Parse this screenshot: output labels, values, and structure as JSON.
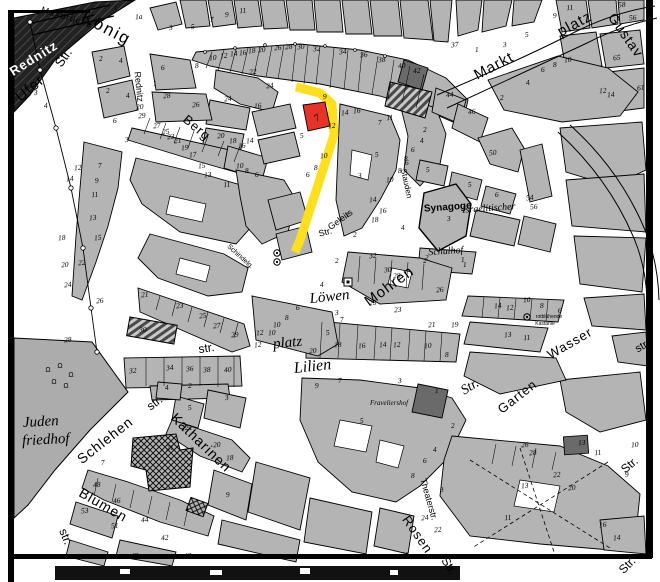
{
  "map": {
    "kind": "historical city cadastral map",
    "highlight": {
      "street_color": "#FFDF1E",
      "parcel_color": "#E63329",
      "parcel_number": "7"
    },
    "street_labels": [
      {
        "t": "Maxbrücke",
        "x": 66,
        "y": 20,
        "r": 17,
        "s": 9,
        "f": "s",
        "sp": 1
      },
      {
        "t": "König",
        "x": 104,
        "y": 33,
        "r": 28,
        "s": 17,
        "f": "s",
        "sp": 2
      },
      {
        "t": "Str.",
        "x": 67,
        "y": 60,
        "r": -55,
        "s": 13,
        "f": "s"
      },
      {
        "t": "Ufer",
        "x": 33,
        "y": 92,
        "r": -40,
        "s": 15,
        "f": "s",
        "sp": 1
      },
      {
        "t": "Rednitz",
        "x": 136,
        "y": 87,
        "r": 84,
        "s": 9,
        "f": "s"
      },
      {
        "t": "Berg",
        "x": 194,
        "y": 131,
        "r": 40,
        "s": 13,
        "f": "s",
        "sp": 1
      },
      {
        "t": "Markt",
        "x": 496,
        "y": 70,
        "r": -28,
        "s": 15,
        "f": "s",
        "sp": 1
      },
      {
        "t": "platz",
        "x": 577,
        "y": 28,
        "r": -28,
        "s": 15,
        "f": "s",
        "sp": 1
      },
      {
        "t": "Gustav",
        "x": 622,
        "y": 38,
        "r": 55,
        "s": 14,
        "f": "s",
        "sp": 1
      },
      {
        "t": "Stauden",
        "x": 404,
        "y": 184,
        "r": 78,
        "s": 8,
        "f": "s"
      },
      {
        "t": "Geleits",
        "x": 342,
        "y": 222,
        "r": -36,
        "s": 9,
        "f": "s"
      },
      {
        "t": "Str.",
        "x": 326,
        "y": 235,
        "r": -15,
        "s": 9,
        "f": "s"
      },
      {
        "t": "Schindelg.",
        "x": 239,
        "y": 258,
        "r": 42,
        "s": 7,
        "f": "s"
      },
      {
        "t": "Mohren",
        "x": 392,
        "y": 290,
        "r": -36,
        "s": 15,
        "f": "s",
        "sp": 1
      },
      {
        "t": "Löwen",
        "x": 330,
        "y": 301,
        "r": -6,
        "s": 15,
        "f": "i"
      },
      {
        "t": "platz",
        "x": 288,
        "y": 347,
        "r": -6,
        "s": 15,
        "f": "i"
      },
      {
        "t": "str.",
        "x": 207,
        "y": 352,
        "r": -8,
        "s": 12,
        "f": "s"
      },
      {
        "t": "Lilien",
        "x": 313,
        "y": 371,
        "r": -6,
        "s": 16,
        "f": "i"
      },
      {
        "t": "Str.",
        "x": 472,
        "y": 390,
        "r": -32,
        "s": 14,
        "f": "i"
      },
      {
        "t": "Schlehen",
        "x": 108,
        "y": 444,
        "r": -38,
        "s": 14,
        "f": "s",
        "sp": 1
      },
      {
        "t": "str.",
        "x": 157,
        "y": 406,
        "r": -36,
        "s": 12,
        "f": "s"
      },
      {
        "t": "Katharinen",
        "x": 198,
        "y": 446,
        "r": 44,
        "s": 14,
        "f": "s",
        "sp": 1
      },
      {
        "t": "Blumen",
        "x": 101,
        "y": 509,
        "r": 30,
        "s": 14,
        "f": "s",
        "sp": 1
      },
      {
        "t": "str.",
        "x": 62,
        "y": 538,
        "r": 68,
        "s": 12,
        "f": "s"
      },
      {
        "t": "Theaterstr.",
        "x": 426,
        "y": 500,
        "r": 74,
        "s": 9,
        "f": "s"
      },
      {
        "t": "Rosen",
        "x": 414,
        "y": 537,
        "r": 55,
        "s": 13,
        "f": "s",
        "sp": 1
      },
      {
        "t": "Str.",
        "x": 446,
        "y": 568,
        "r": 55,
        "s": 12,
        "f": "s"
      },
      {
        "t": "Wasser",
        "x": 572,
        "y": 347,
        "r": -30,
        "s": 13,
        "f": "s",
        "sp": 1
      },
      {
        "t": "str.",
        "x": 644,
        "y": 349,
        "r": -30,
        "s": 11,
        "f": "s"
      },
      {
        "t": "Garten",
        "x": 520,
        "y": 400,
        "r": -38,
        "s": 13,
        "f": "s",
        "sp": 1
      },
      {
        "t": "Str.",
        "x": 632,
        "y": 468,
        "r": -40,
        "s": 12,
        "f": "s"
      },
      {
        "t": "Str.",
        "x": 630,
        "y": 568,
        "r": -45,
        "s": 12,
        "f": "s"
      }
    ],
    "place_labels": [
      {
        "t": "Rednitz",
        "x": 36,
        "y": 62,
        "r": -32,
        "s": 13,
        "f": "w",
        "sp": 1
      },
      {
        "t": "Juden",
        "x": 41,
        "y": 426,
        "r": -3,
        "s": 15,
        "f": "i"
      },
      {
        "t": "friedhof",
        "x": 46,
        "y": 444,
        "r": -3,
        "s": 15,
        "f": "i"
      },
      {
        "t": "Synagoge",
        "x": 448,
        "y": 210,
        "r": -4,
        "s": 10,
        "f": "b"
      },
      {
        "t": "Israelitischer",
        "x": 489,
        "y": 211,
        "r": -4,
        "s": 10,
        "f": "i"
      },
      {
        "t": "Schulhof",
        "x": 446,
        "y": 254,
        "r": -4,
        "s": 10,
        "f": "i"
      },
      {
        "t": "Fraveliershof",
        "x": 389,
        "y": 405,
        "r": 0,
        "s": 7,
        "f": "i"
      },
      {
        "t": "rotblühende",
        "x": 549,
        "y": 318,
        "r": 0,
        "s": 5,
        "f": "s"
      },
      {
        "t": "Kastanie",
        "x": 545,
        "y": 325,
        "r": 0,
        "s": 5,
        "f": "s"
      }
    ],
    "house_numbers": [
      [
        "1",
        116,
        10
      ],
      [
        "1a",
        139,
        19
      ],
      [
        "3",
        171,
        30
      ],
      [
        "5",
        193,
        29
      ],
      [
        "7",
        212,
        22
      ],
      [
        "9",
        227,
        17
      ],
      [
        "11",
        243,
        13
      ],
      [
        "2",
        101,
        61
      ],
      [
        "4",
        121,
        63
      ],
      [
        "6",
        163,
        70
      ],
      [
        "8",
        197,
        68
      ],
      [
        "1",
        155,
        86
      ],
      [
        "28",
        167,
        98
      ],
      [
        "26",
        196,
        107
      ],
      [
        "3",
        36,
        95
      ],
      [
        "2",
        108,
        93
      ],
      [
        "4",
        128,
        98
      ],
      [
        "4",
        46,
        108
      ],
      [
        "20",
        140,
        109
      ],
      [
        "10",
        213,
        60
      ],
      [
        "12",
        224,
        58
      ],
      [
        "14",
        234,
        56
      ],
      [
        "16",
        243,
        55
      ],
      [
        "18",
        252,
        53
      ],
      [
        "20",
        262,
        52
      ],
      [
        "26",
        278,
        50
      ],
      [
        "28",
        289,
        49
      ],
      [
        "30",
        301,
        49
      ],
      [
        "32",
        317,
        51
      ],
      [
        "34",
        343,
        54
      ],
      [
        "36",
        364,
        57
      ],
      [
        "38",
        382,
        62
      ],
      [
        "40",
        402,
        68
      ],
      [
        "42",
        417,
        73
      ],
      [
        "44",
        450,
        97
      ],
      [
        "46",
        472,
        114
      ],
      [
        "22",
        253,
        74
      ],
      [
        "24",
        270,
        88
      ],
      [
        "16",
        258,
        108
      ],
      [
        "24",
        228,
        101
      ],
      [
        "20",
        221,
        138
      ],
      [
        "29",
        142,
        118
      ],
      [
        "27",
        157,
        128
      ],
      [
        "25",
        166,
        134
      ],
      [
        "23",
        171,
        139
      ],
      [
        "21",
        178,
        143
      ],
      [
        "19",
        185,
        150
      ],
      [
        "17",
        193,
        157
      ],
      [
        "15",
        202,
        168
      ],
      [
        "13",
        208,
        177
      ],
      [
        "11",
        227,
        187
      ],
      [
        "18",
        233,
        143
      ],
      [
        "16",
        242,
        148
      ],
      [
        "14",
        250,
        143
      ],
      [
        "10",
        240,
        168
      ],
      [
        "8",
        247,
        173
      ],
      [
        "6",
        257,
        177
      ],
      [
        "3",
        127,
        142
      ],
      [
        "6",
        115,
        123
      ],
      [
        "12",
        78,
        170
      ],
      [
        "14",
        70,
        181
      ],
      [
        "7",
        100,
        168
      ],
      [
        "9",
        97,
        183
      ],
      [
        "11",
        95,
        197
      ],
      [
        "13",
        93,
        220
      ],
      [
        "15",
        98,
        240
      ],
      [
        "18",
        62,
        240
      ],
      [
        "20",
        65,
        267
      ],
      [
        "22",
        82,
        265
      ],
      [
        "24",
        68,
        287
      ],
      [
        "26",
        100,
        303
      ],
      [
        "28",
        68,
        342
      ],
      [
        "9",
        325,
        99
      ],
      [
        "5",
        302,
        138
      ],
      [
        "12",
        332,
        128
      ],
      [
        "10",
        324,
        158
      ],
      [
        "8",
        316,
        170
      ],
      [
        "6",
        308,
        177
      ],
      [
        "14",
        345,
        115
      ],
      [
        "16",
        357,
        113
      ],
      [
        "11",
        390,
        120
      ],
      [
        "1",
        348,
        217
      ],
      [
        "3",
        360,
        178
      ],
      [
        "5",
        377,
        157
      ],
      [
        "2",
        355,
        237
      ],
      [
        "10",
        390,
        182
      ],
      [
        "8",
        400,
        173
      ],
      [
        "6",
        407,
        165
      ],
      [
        "16",
        383,
        213
      ],
      [
        "18",
        375,
        222
      ],
      [
        "4",
        403,
        230
      ],
      [
        "14",
        373,
        202
      ],
      [
        "7",
        380,
        125
      ],
      [
        "2",
        425,
        132
      ],
      [
        "4",
        422,
        143
      ],
      [
        "6",
        413,
        152
      ],
      [
        "8",
        406,
        161
      ],
      [
        "50",
        493,
        155
      ],
      [
        "5",
        428,
        172
      ],
      [
        "5",
        470,
        187
      ],
      [
        "6",
        497,
        197
      ],
      [
        "54",
        530,
        200
      ],
      [
        "56",
        534,
        209
      ],
      [
        "2",
        427,
        260
      ],
      [
        "1",
        463,
        262
      ],
      [
        "3",
        449,
        221
      ],
      [
        "37",
        455,
        47
      ],
      [
        "1",
        477,
        52
      ],
      [
        "3",
        505,
        47
      ],
      [
        "5",
        527,
        37
      ],
      [
        "9",
        555,
        18
      ],
      [
        "11",
        570,
        10
      ],
      [
        "58",
        622,
        7
      ],
      [
        "56",
        633,
        20
      ],
      [
        "65",
        617,
        60
      ],
      [
        "2",
        502,
        100
      ],
      [
        "4",
        528,
        85
      ],
      [
        "6",
        543,
        72
      ],
      [
        "8",
        555,
        67
      ],
      [
        "10",
        568,
        62
      ],
      [
        "12",
        603,
        93
      ],
      [
        "14",
        611,
        97
      ],
      [
        "61",
        641,
        90
      ],
      [
        "32",
        373,
        258
      ],
      [
        "30",
        388,
        272
      ],
      [
        "28",
        397,
        278
      ],
      [
        "2",
        425,
        263
      ],
      [
        "26",
        440,
        292
      ],
      [
        "1",
        465,
        267
      ],
      [
        "25",
        373,
        305
      ],
      [
        "23",
        398,
        312
      ],
      [
        "21",
        432,
        327
      ],
      [
        "19",
        455,
        327
      ],
      [
        "16",
        362,
        348
      ],
      [
        "14",
        383,
        347
      ],
      [
        "12",
        397,
        347
      ],
      [
        "10",
        428,
        348
      ],
      [
        "8",
        447,
        357
      ],
      [
        "20",
        313,
        353
      ],
      [
        "18",
        338,
        347
      ],
      [
        "5",
        328,
        335
      ],
      [
        "7",
        342,
        322
      ],
      [
        "3",
        337,
        315
      ],
      [
        "4",
        322,
        287
      ],
      [
        "6",
        298,
        310
      ],
      [
        "8",
        287,
        320
      ],
      [
        "10",
        277,
        327
      ],
      [
        "12",
        260,
        335
      ],
      [
        "2",
        337,
        263
      ],
      [
        "21",
        145,
        297
      ],
      [
        "23",
        180,
        308
      ],
      [
        "25",
        203,
        318
      ],
      [
        "27",
        217,
        328
      ],
      [
        "29",
        235,
        337
      ],
      [
        "12",
        258,
        347
      ],
      [
        "10",
        272,
        335
      ],
      [
        "30",
        143,
        332
      ],
      [
        "32",
        133,
        373
      ],
      [
        "34",
        170,
        370
      ],
      [
        "36",
        190,
        371
      ],
      [
        "38",
        207,
        372
      ],
      [
        "40",
        228,
        372
      ],
      [
        "4",
        167,
        390
      ],
      [
        "2",
        190,
        388
      ],
      [
        "14",
        498,
        308
      ],
      [
        "12",
        510,
        310
      ],
      [
        "10",
        527,
        302
      ],
      [
        "8",
        542,
        308
      ],
      [
        "6",
        560,
        313
      ],
      [
        "13",
        508,
        337
      ],
      [
        "11",
        527,
        340
      ],
      [
        "9",
        317,
        388
      ],
      [
        "7",
        340,
        383
      ],
      [
        "3",
        400,
        383
      ],
      [
        "5",
        362,
        423
      ],
      [
        "1",
        437,
        393
      ],
      [
        "2",
        453,
        428
      ],
      [
        "4",
        435,
        452
      ],
      [
        "6",
        425,
        463
      ],
      [
        "8",
        413,
        478
      ],
      [
        "5",
        190,
        410
      ],
      [
        "3",
        227,
        400
      ],
      [
        "22",
        185,
        430
      ],
      [
        "20",
        217,
        447
      ],
      [
        "18",
        230,
        460
      ],
      [
        "21",
        170,
        450
      ],
      [
        "48",
        97,
        487
      ],
      [
        "46",
        117,
        503
      ],
      [
        "53",
        85,
        513
      ],
      [
        "51",
        115,
        528
      ],
      [
        "44",
        145,
        522
      ],
      [
        "42",
        165,
        540
      ],
      [
        "40",
        188,
        558
      ],
      [
        "49",
        135,
        558
      ],
      [
        "9",
        228,
        497
      ],
      [
        "7",
        103,
        465
      ],
      [
        "24",
        425,
        520
      ],
      [
        "22",
        438,
        532
      ],
      [
        "21",
        405,
        557
      ],
      [
        "3",
        442,
        492
      ],
      [
        "13",
        525,
        488
      ],
      [
        "11",
        508,
        520
      ],
      [
        "26",
        525,
        447
      ],
      [
        "28",
        533,
        455
      ],
      [
        "20",
        572,
        490
      ],
      [
        "22",
        557,
        477
      ],
      [
        "13",
        582,
        445
      ],
      [
        "11",
        598,
        455
      ],
      [
        "9",
        627,
        477
      ],
      [
        "16",
        603,
        527
      ],
      [
        "14",
        617,
        540
      ],
      [
        "10",
        635,
        447
      ]
    ],
    "symbols": {
      "trees": [
        [
          527,
          317
        ],
        [
          277,
          253
        ],
        [
          277,
          262
        ]
      ],
      "graves": [
        [
          48,
          372
        ],
        [
          60,
          368
        ],
        [
          71,
          377
        ],
        [
          54,
          384
        ],
        [
          66,
          388
        ]
      ],
      "monument": [
        348,
        282
      ]
    }
  }
}
